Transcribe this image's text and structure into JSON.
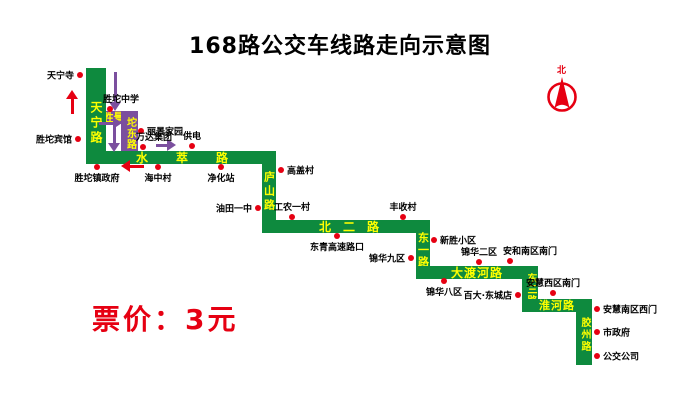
{
  "title": "168路公交车线路走向示意图",
  "fare_notice": "票价：3元",
  "compass": {
    "label": "北"
  },
  "colors": {
    "route_green": "#0E8A3E",
    "loop_purple": "#7B4F9E",
    "road_label_yellow": "#FFFF00",
    "accent_red": "#E60012",
    "text_black": "#000000"
  },
  "roads": [
    {
      "label": "天宁路",
      "orientation": "vertical",
      "color": "green"
    },
    {
      "label": "胜景路",
      "orientation": "horizontal",
      "color": "purple"
    },
    {
      "label": "坨东路",
      "orientation": "vertical",
      "color": "purple"
    },
    {
      "label": "水萃路",
      "orientation": "horizontal",
      "color": "green"
    },
    {
      "label": "庐山路",
      "orientation": "vertical",
      "color": "green"
    },
    {
      "label": "北二路",
      "orientation": "horizontal",
      "color": "green"
    },
    {
      "label": "东一路",
      "orientation": "vertical",
      "color": "green"
    },
    {
      "label": "大渡河路",
      "orientation": "horizontal",
      "color": "green"
    },
    {
      "label": "东三路",
      "orientation": "vertical",
      "color": "green"
    },
    {
      "label": "淮河路",
      "orientation": "horizontal",
      "color": "green"
    },
    {
      "label": "胶州路",
      "orientation": "vertical",
      "color": "green"
    }
  ],
  "stops": [
    {
      "name": "天宁寺"
    },
    {
      "name": "胜坨宾馆"
    },
    {
      "name": "胜坨中学"
    },
    {
      "name": "丽景家园"
    },
    {
      "name": "万达集团"
    },
    {
      "name": "供电"
    },
    {
      "name": "胜坨镇政府"
    },
    {
      "name": "海中村"
    },
    {
      "name": "净化站"
    },
    {
      "name": "高盖村"
    },
    {
      "name": "油田一中"
    },
    {
      "name": "工农一村"
    },
    {
      "name": "丰收村"
    },
    {
      "name": "东青高速路口"
    },
    {
      "name": "新胜小区"
    },
    {
      "name": "锦华九区"
    },
    {
      "name": "锦华二区"
    },
    {
      "name": "安和南区南门"
    },
    {
      "name": "锦华八区"
    },
    {
      "name": "百大·东城店"
    },
    {
      "name": "安慧西区南门"
    },
    {
      "name": "安慧南区西门"
    },
    {
      "name": "市政府"
    },
    {
      "name": "公交公司"
    }
  ],
  "arrows": [
    {
      "direction": "up",
      "color": "red"
    },
    {
      "direction": "down",
      "color": "purple"
    },
    {
      "direction": "right",
      "color": "purple"
    },
    {
      "direction": "down",
      "color": "purple"
    },
    {
      "direction": "right",
      "color": "purple"
    },
    {
      "direction": "left",
      "color": "red"
    }
  ]
}
